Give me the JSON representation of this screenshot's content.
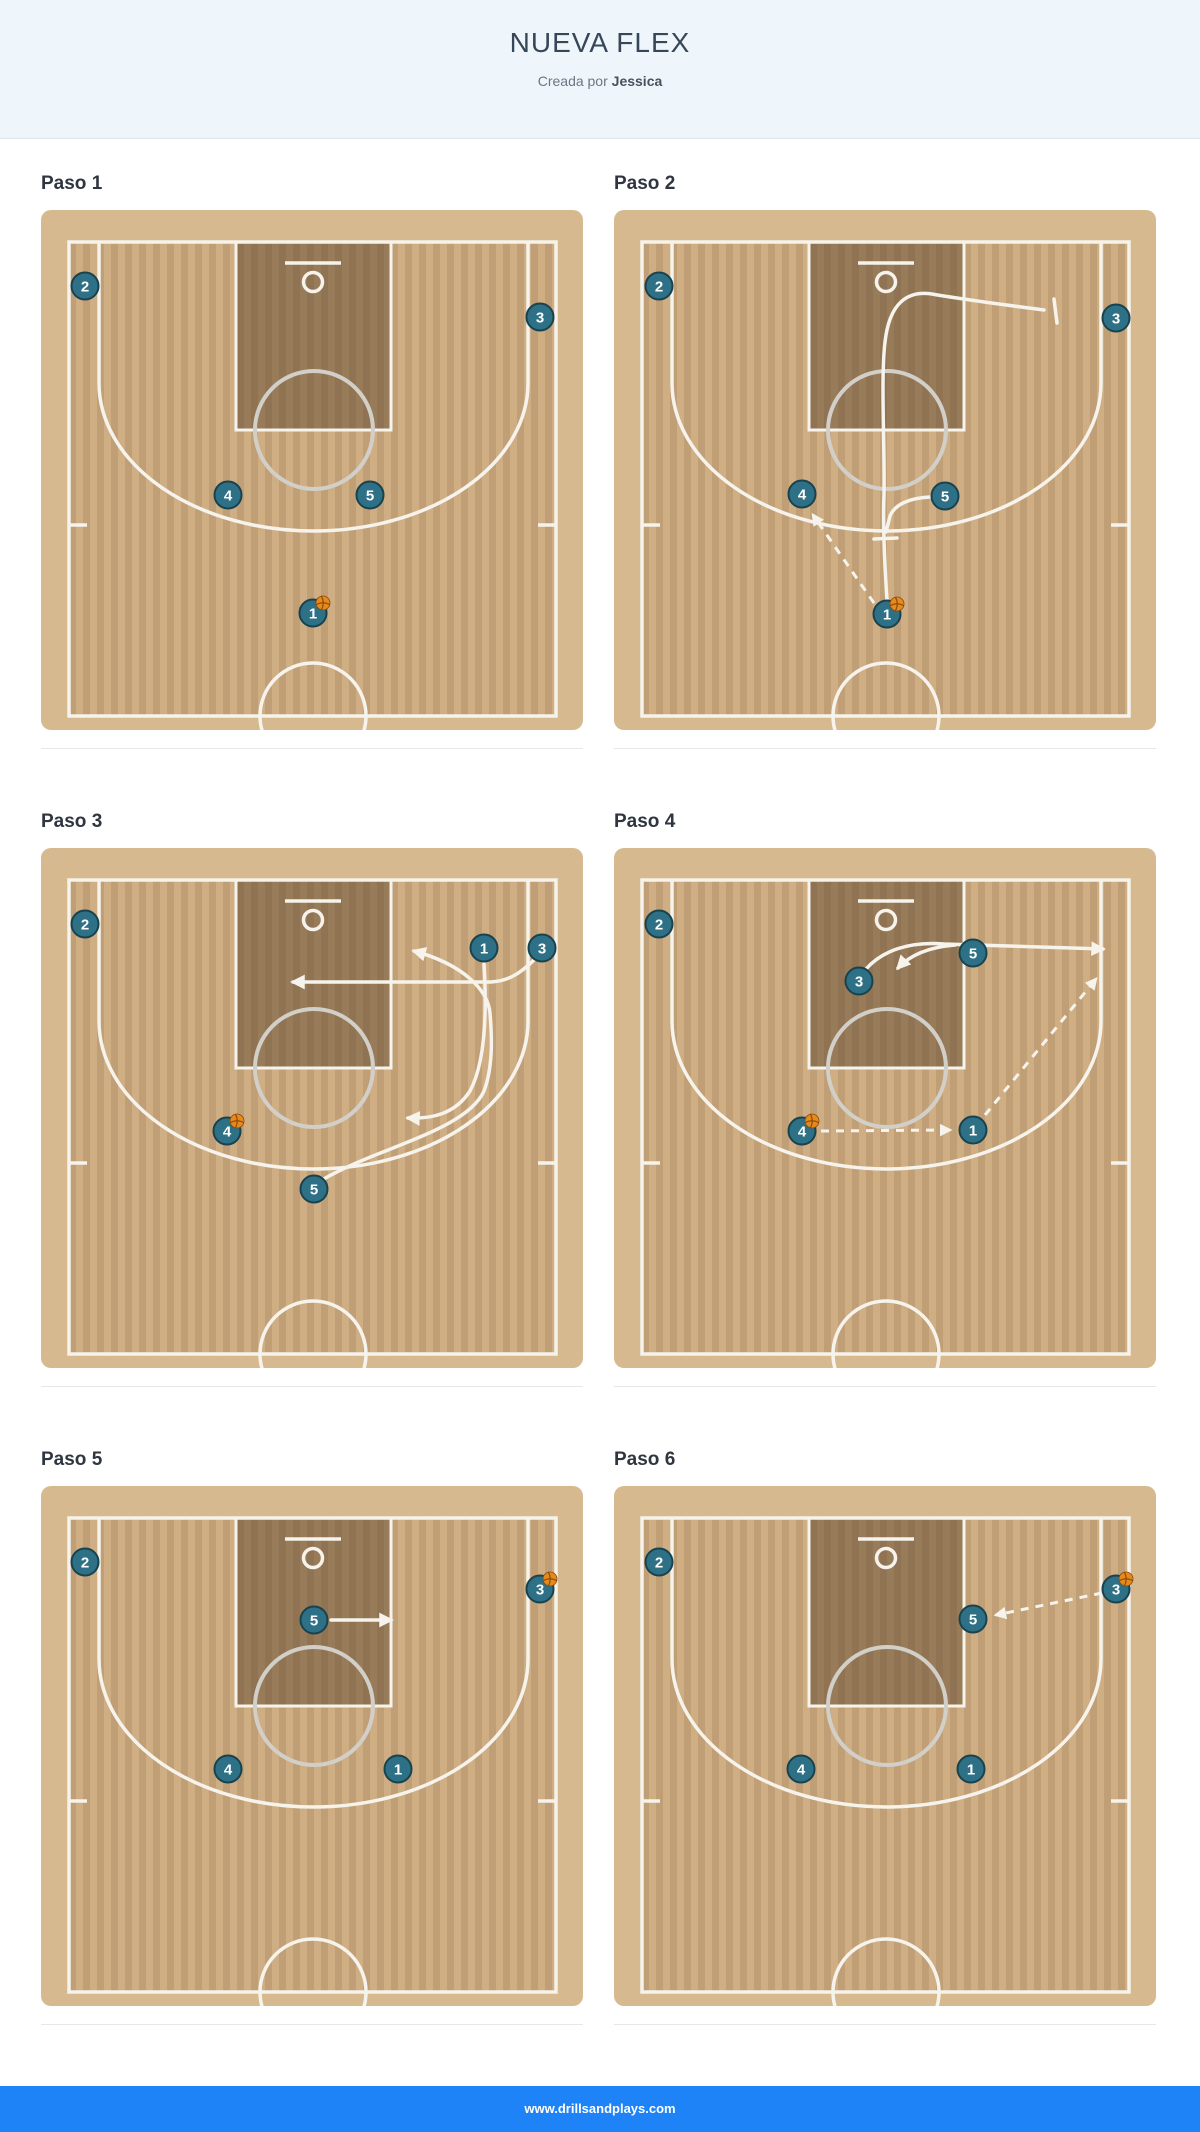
{
  "header": {
    "title": "NUEVA FLEX",
    "subtitle_prefix": "Creada por",
    "author": "Jessica"
  },
  "footer": {
    "url": "www.drillsandplays.com"
  },
  "colors": {
    "header_bg": "#eff6fb",
    "footer_blue": "#1e83f7",
    "court_tan": "#d7b98f",
    "court_floor": "#cfae84",
    "paint_overlay": "rgba(77,55,30,0.42)",
    "line_white": "#f6f3ec",
    "ft_circle_gray": "#d2cfc9",
    "player_fill": "#2e7186",
    "player_border": "#19424f",
    "ball_orange": "#e78a1c",
    "ball_seam": "#8a4a0c"
  },
  "steps": [
    {
      "label": "Paso 1",
      "players": [
        {
          "n": "2",
          "x": 44,
          "y": 76
        },
        {
          "n": "3",
          "x": 499,
          "y": 107
        },
        {
          "n": "4",
          "x": 187,
          "y": 285
        },
        {
          "n": "5",
          "x": 329,
          "y": 285
        },
        {
          "n": "1",
          "x": 272,
          "y": 403,
          "ball": true
        }
      ],
      "lines": [],
      "bars": []
    },
    {
      "label": "Paso 2",
      "players": [
        {
          "n": "2",
          "x": 45,
          "y": 76
        },
        {
          "n": "3",
          "x": 502,
          "y": 108
        },
        {
          "n": "4",
          "x": 188,
          "y": 284
        },
        {
          "n": "5",
          "x": 331,
          "y": 286
        },
        {
          "n": "1",
          "x": 273,
          "y": 404,
          "ball": true
        }
      ],
      "lines": [
        {
          "kind": "cut",
          "d": "M 273 390 C 270 345 269 310 270 285 C 271 235 266 160 272 125 C 277 95 292 80 318 84 C 352 90 400 96 430 100",
          "arrow": false
        },
        {
          "kind": "cut",
          "d": "M 316 287 C 296 288 281 294 276 306 L 272 322",
          "arrow": false
        },
        {
          "kind": "pass",
          "d": "M 260 393 L 199 305",
          "arrow": true
        }
      ],
      "bars": [
        {
          "x1": 440,
          "y1": 89,
          "x2": 443,
          "y2": 113
        },
        {
          "x1": 260,
          "y1": 329,
          "x2": 283,
          "y2": 328
        }
      ]
    },
    {
      "label": "Paso 3",
      "players": [
        {
          "n": "2",
          "x": 44,
          "y": 76
        },
        {
          "n": "1",
          "x": 443,
          "y": 100
        },
        {
          "n": "3",
          "x": 501,
          "y": 100
        },
        {
          "n": "4",
          "x": 186,
          "y": 283,
          "ball": true
        },
        {
          "n": "5",
          "x": 273,
          "y": 341
        }
      ],
      "lines": [
        {
          "kind": "cut",
          "d": "M 494 111 C 478 127 466 133 450 134 L 252 134",
          "arrow": true
        },
        {
          "kind": "cut",
          "d": "M 443 116 C 446 165 444 215 429 243 C 414 266 391 271 367 270",
          "arrow": true
        },
        {
          "kind": "cut",
          "d": "M 281 332 C 335 300 425 283 443 243 C 452 219 451 190 449 165 C 447 143 424 117 373 103",
          "arrow": true
        }
      ],
      "bars": []
    },
    {
      "label": "Paso 4",
      "players": [
        {
          "n": "2",
          "x": 45,
          "y": 76
        },
        {
          "n": "3",
          "x": 245,
          "y": 133
        },
        {
          "n": "5",
          "x": 359,
          "y": 105
        },
        {
          "n": "4",
          "x": 188,
          "y": 283,
          "ball": true
        },
        {
          "n": "1",
          "x": 359,
          "y": 282
        }
      ],
      "lines": [
        {
          "kind": "cut",
          "d": "M 252 121 C 268 103 295 93 330 96 L 489 101",
          "arrow": true
        },
        {
          "kind": "cut",
          "d": "M 341 97 C 317 99 297 106 284 120",
          "arrow": true
        },
        {
          "kind": "pass",
          "d": "M 207 283 L 336 282",
          "arrow": true
        },
        {
          "kind": "pass",
          "d": "M 371 267 L 482 131",
          "arrow": true
        }
      ],
      "bars": []
    },
    {
      "label": "Paso 5",
      "players": [
        {
          "n": "2",
          "x": 44,
          "y": 76
        },
        {
          "n": "3",
          "x": 499,
          "y": 103,
          "ball": true
        },
        {
          "n": "5",
          "x": 273,
          "y": 134
        },
        {
          "n": "4",
          "x": 187,
          "y": 283
        },
        {
          "n": "1",
          "x": 357,
          "y": 283
        }
      ],
      "lines": [
        {
          "kind": "cut",
          "d": "M 290 134 L 350 134",
          "arrow": true
        }
      ],
      "bars": []
    },
    {
      "label": "Paso 6",
      "players": [
        {
          "n": "2",
          "x": 45,
          "y": 76
        },
        {
          "n": "3",
          "x": 502,
          "y": 103,
          "ball": true
        },
        {
          "n": "5",
          "x": 359,
          "y": 133
        },
        {
          "n": "4",
          "x": 187,
          "y": 283
        },
        {
          "n": "1",
          "x": 357,
          "y": 283
        }
      ],
      "lines": [
        {
          "kind": "pass",
          "d": "M 488 107 L 382 129",
          "arrow": true
        }
      ],
      "bars": []
    }
  ]
}
